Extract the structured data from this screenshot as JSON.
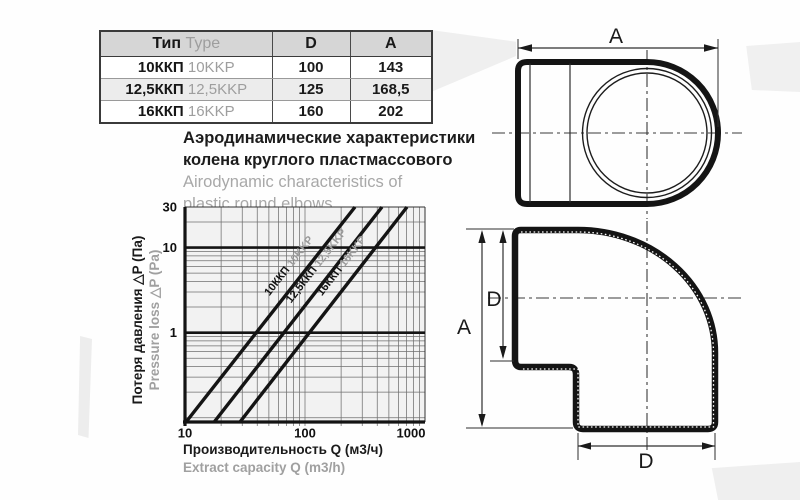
{
  "table": {
    "headers": {
      "type_ru": "Тип",
      "type_en": "Type",
      "d": "D",
      "a": "A"
    },
    "rows": [
      {
        "type_ru": "10ККП",
        "type_en": "10KKP",
        "d": "100",
        "a": "143"
      },
      {
        "type_ru": "12,5ККП",
        "type_en": "12,5KKP",
        "d": "125",
        "a": "168,5"
      },
      {
        "type_ru": "16ККП",
        "type_en": "16KKP",
        "d": "160",
        "a": "202"
      }
    ]
  },
  "title": {
    "ru1": "Аэродинамические характеристики",
    "ru2": "колена круглого пластмассового",
    "en1": "Airodynamic characteristics of",
    "en2": "plastic round elbows"
  },
  "chart_data": {
    "type": "line",
    "x_scale": "log",
    "y_scale": "log",
    "xlim": [
      10,
      1000
    ],
    "ylim": [
      0.089,
      30
    ],
    "x_ticks": [
      10,
      100,
      1000
    ],
    "y_ticks": [
      30,
      10,
      1
    ],
    "emphasis_y": [
      10,
      1
    ],
    "grid": "log minor grid on",
    "xlabel_ru": "Производительность Q (м3/ч)",
    "xlabel_en": "Extract capacity Q (m3/h)",
    "ylabel_ru": "Потеря давления △P (Па)",
    "ylabel_en": "Pressure loss △P (Pa)",
    "series": [
      {
        "label_ru": "10ККП",
        "label_en": "10KKP",
        "points": [
          [
            10.2,
            0.089
          ],
          [
            261,
            30
          ]
        ]
      },
      {
        "label_ru": "12,5ККП",
        "label_en": "12,5KKP",
        "points": [
          [
            17.5,
            0.089
          ],
          [
            438,
            30
          ]
        ]
      },
      {
        "label_ru": "16ККП",
        "label_en": "16KKP",
        "points": [
          [
            28.7,
            0.089
          ],
          [
            708,
            30
          ]
        ]
      }
    ]
  },
  "drawings": {
    "dim_a_top": "A",
    "dim_a_side": "A",
    "dim_d_side": "D",
    "dim_d_bottom": "D"
  },
  "colors": {
    "ink_black": "#141414",
    "muted_gray": "#9b9b9b",
    "grid_gray": "#6f6f6f",
    "plot_bg": "#f2f2f2",
    "table_header_bg": "#d6d6d6",
    "row_alt_bg": "#ececec"
  }
}
